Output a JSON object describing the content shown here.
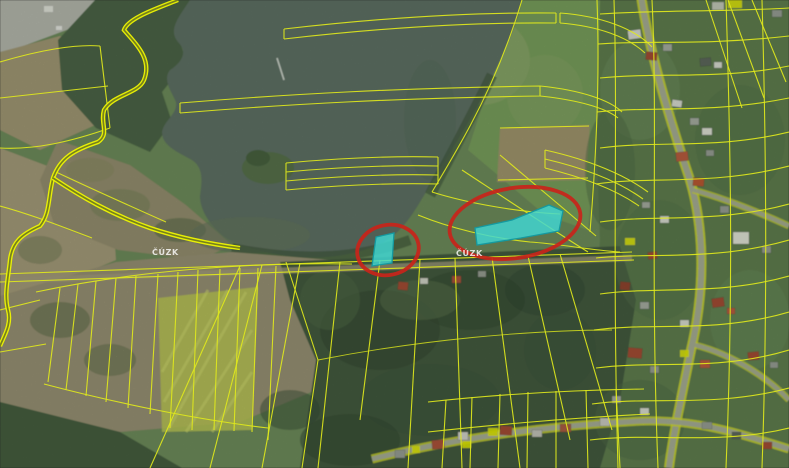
{
  "map": {
    "kind": "cadastral-orthophoto-view",
    "watermarks": [
      {
        "text": "ČÚZK"
      },
      {
        "text": "ČÚZK"
      }
    ],
    "colors": {
      "cadastral_line": "#dfe81c",
      "cadastral_line_bright": "#eef602",
      "highlight_fill": "#3fd8d4",
      "highlight_stroke": "#15999f",
      "annotation_red": "#c9241a",
      "water": "#5d7065",
      "forest": "#41583d",
      "village_green": "#5e7e4e",
      "field_light_green": "#7aa15c",
      "field_tan": "#a39a78",
      "field_yellow": "#c0cb55"
    },
    "highlighted_parcels": [
      {
        "name": "small-parcel",
        "points": "376,237 394,233 392,263 372,266"
      },
      {
        "name": "large-parcel",
        "points": "475,228 512,220 549,205 563,211 559,231 521,238 477,245"
      }
    ],
    "annotations": [
      {
        "name": "small-ellipse",
        "cx": "388",
        "cy": "250",
        "rx": "31",
        "ry": "25",
        "transform": "rotate(-12 388 250)"
      },
      {
        "name": "large-ellipse",
        "cx": "515",
        "cy": "223",
        "rx": "66",
        "ry": "35",
        "transform": "rotate(-9 515 223)"
      }
    ]
  }
}
